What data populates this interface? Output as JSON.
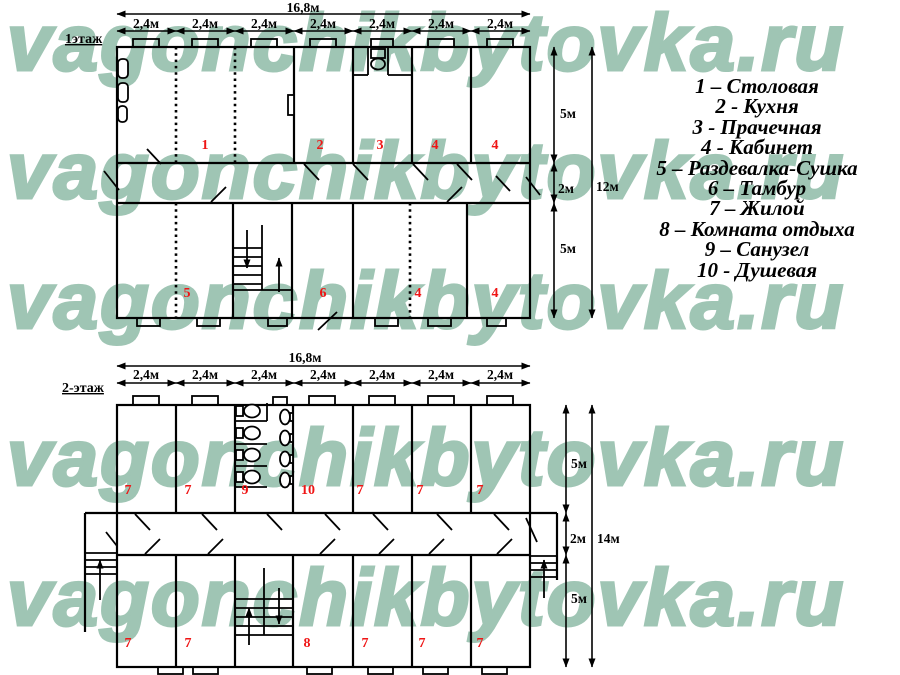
{
  "watermark": {
    "text": "vagonchikbytovka.ru",
    "color": "#9fc5b4"
  },
  "colors": {
    "line": "#000000",
    "room_number": "#ef1515",
    "background": "#ffffff"
  },
  "floor1": {
    "label": "1этаж",
    "total_width": "16,8м",
    "module_width": "2,4м",
    "dims_right": {
      "top": "5м",
      "mid": "2м",
      "bottom": "5м",
      "total": "12м"
    },
    "rooms_top": [
      "1",
      "2",
      "3",
      "4",
      "4"
    ],
    "rooms_bottom": [
      "5",
      "6",
      "4",
      "4"
    ]
  },
  "floor2": {
    "label": "2-этаж",
    "total_width": "16,8м",
    "module_width": "2,4м",
    "dims_right": {
      "top": "5м",
      "mid": "2м",
      "bottom": "5м",
      "total": "14м"
    },
    "rooms_top": [
      "7",
      "7",
      "9",
      "10",
      "7",
      "7",
      "7"
    ],
    "rooms_bottom": [
      "7",
      "7",
      "8",
      "7",
      "7",
      "7"
    ]
  },
  "legend": {
    "items": [
      "1 – Столовая",
      "2 - Кухня",
      "3 - Прачечная",
      "4 - Кабинет",
      "5 – Раздевалка-Сушка",
      "6 – Тамбур",
      "7 – Жилой",
      "8 – Комната отдыха",
      "9 – Санузел",
      "10 - Душевая"
    ]
  }
}
